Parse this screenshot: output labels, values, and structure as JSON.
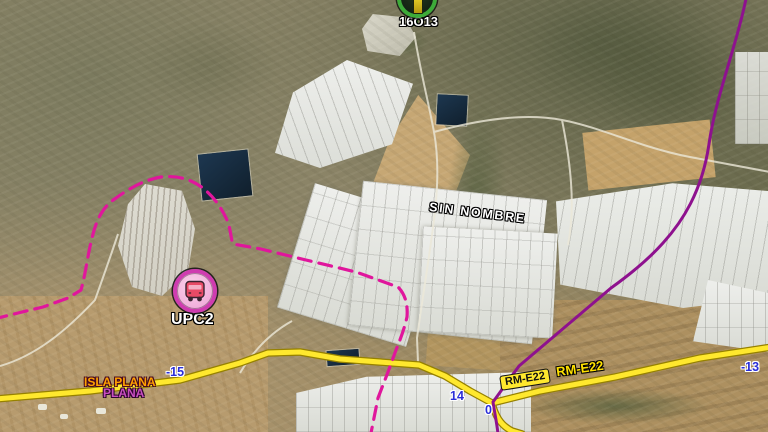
{
  "map": {
    "stops": {
      "s16o13": {
        "label": "16O13"
      },
      "upc2": {
        "label": "UPC2"
      }
    },
    "places": {
      "sin_nombre": "SIN NOMBRE",
      "isla_plana": "ISLA PLANA",
      "plana": "PLANA"
    },
    "road": {
      "badge_label": "RM-E22",
      "outline_label": "RM-E22"
    },
    "km": {
      "m15": "-15",
      "m14": "14",
      "m0": "0",
      "m13": "-13"
    },
    "colors": {
      "road_yellow": "#ffe82e",
      "road_casing": "#968100",
      "route_solid_magenta": "#8e118e",
      "route_dashed_magenta": "#e0169c",
      "km_blue": "#2a2ed8",
      "water_dark": "#14283a",
      "isla_plana_orange": "#ffa000",
      "plana_magenta": "#c94ec0",
      "marker_green": "#3dab39",
      "marker_pink": "#cf3cb0"
    }
  }
}
